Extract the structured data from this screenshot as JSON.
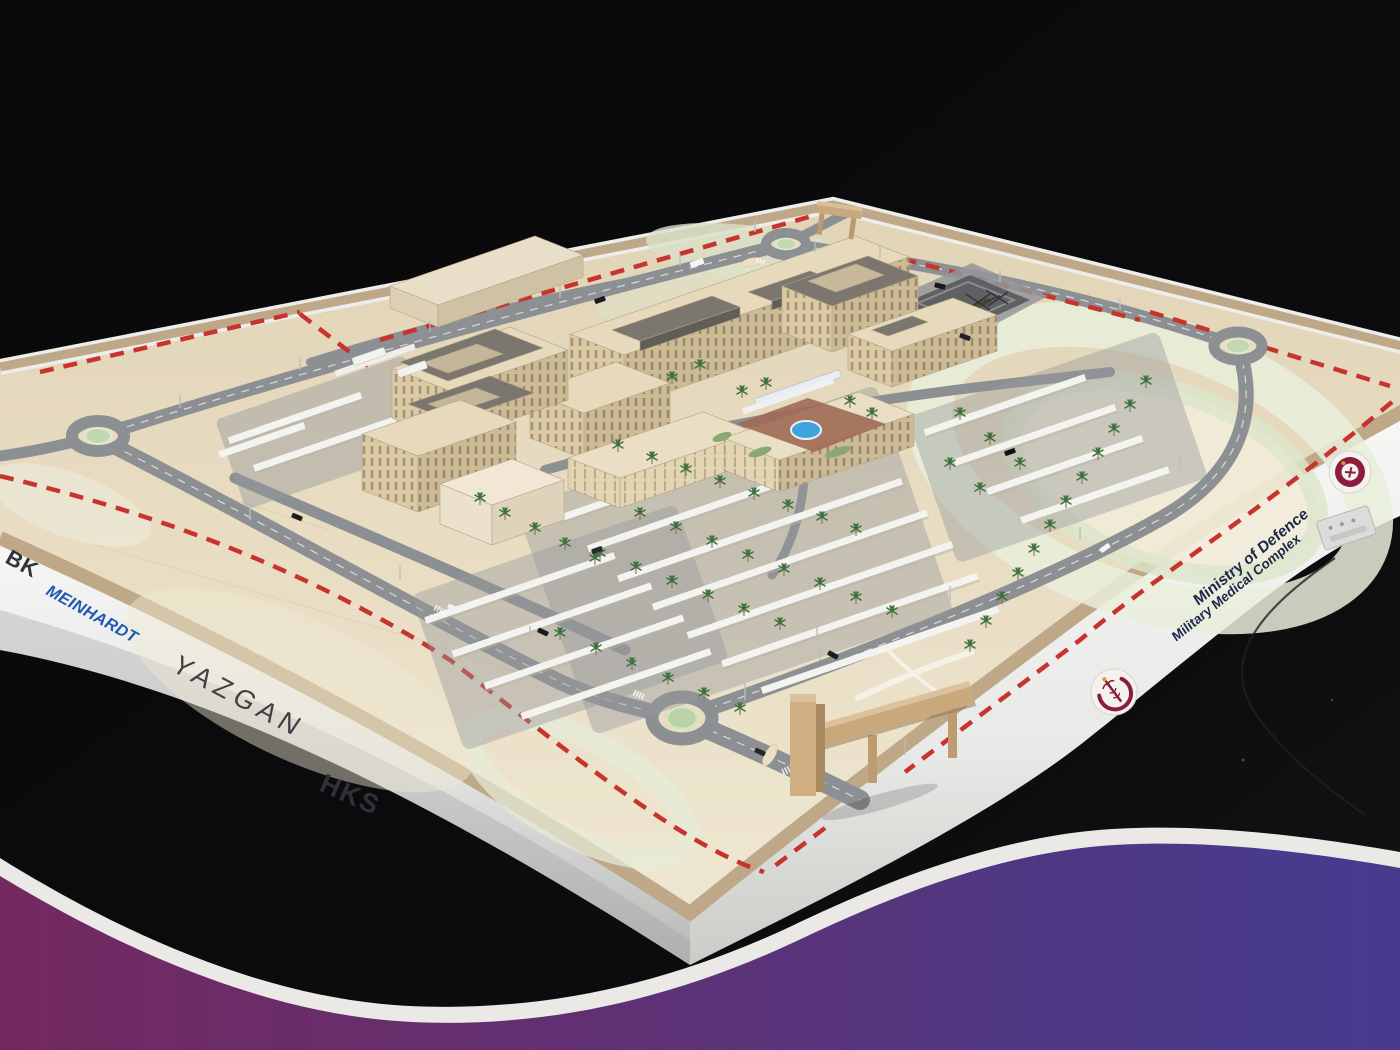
{
  "image": {
    "alt": "Architectural scale model of the Ministry of Defence Military Medical Complex on a black table, framed by a purple wave graphic"
  },
  "signage": {
    "left": {
      "logo1": "BK",
      "logo2": "MEINHARDT",
      "logo3": "YAZGAN",
      "logo4": "HKS"
    },
    "right": {
      "title": "Ministry of Defence",
      "subtitle": "Military Medical Complex"
    }
  },
  "colors": {
    "meinhardt_blue": "#1e5ab5",
    "signage_text": "#2e2e35",
    "ministry_text": "#1d2747",
    "emblem_maroon": "#8c1d40",
    "wave_left": "#73295f",
    "wave_right": "#483b8f",
    "wave_border": "#eae9e5",
    "sand": "#e7dcc2",
    "road": "#8d9093",
    "boundary_red": "#c8332e",
    "building_wall": "#dccaa5",
    "roof_gray": "#7b776f",
    "canopy_white": "#f3f3f0",
    "palm_green": "#3f6f3c",
    "fountain_blue": "#3fa3de",
    "board_tan": "#bfa888",
    "fascia_white": "#f2f2f1",
    "background_black": "#0a0a0c"
  }
}
